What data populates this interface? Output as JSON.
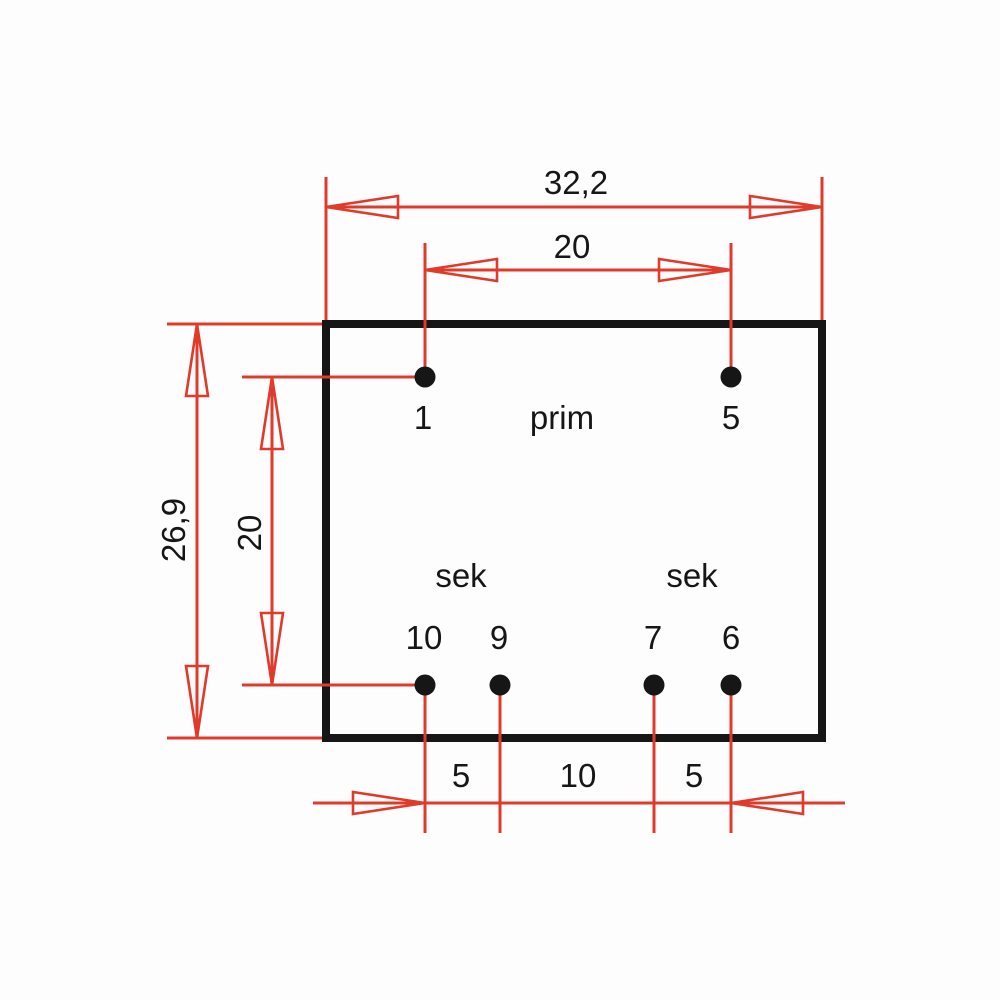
{
  "colors": {
    "dimension_red": "#e03a2b",
    "drawing_black": "#161616",
    "background": "#fdfdfd"
  },
  "labels": {
    "primary_winding": "prim",
    "secondary_winding_left": "sek",
    "secondary_winding_right": "sek"
  },
  "pins": {
    "top": [
      {
        "number": "1"
      },
      {
        "number": "5"
      }
    ],
    "bottom": [
      {
        "number": "10"
      },
      {
        "number": "9"
      },
      {
        "number": "7"
      },
      {
        "number": "6"
      }
    ]
  },
  "dimensions": {
    "overall_width": "32,2",
    "top_pin_pitch": "20",
    "overall_height": "26,9",
    "pin_row_pitch": "20",
    "bottom_pin_pitches": [
      "5",
      "10",
      "5"
    ]
  }
}
